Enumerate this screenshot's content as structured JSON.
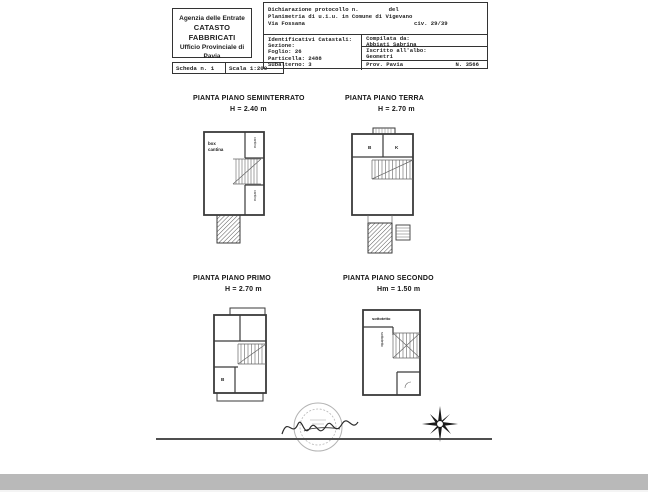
{
  "header": {
    "office": {
      "line1": "Agenzia delle Entrate",
      "line2": "CATASTO FABBRICATI",
      "line3": "Ufficio Provinciale di",
      "line4": "Pavia"
    },
    "sheet": {
      "scheda": "Scheda n. 1",
      "scala": "Scala 1:200"
    },
    "declaration": {
      "protocol": "Dichiarazione protocollo n.",
      "del": "del",
      "planimetria": "Planimetria di u.i.u. in Comune di Vigevano",
      "street": "Via Fossana",
      "civ": "civ. 29/39"
    },
    "catasto": {
      "title": "Identificativi Catastali:",
      "sezione": "Sezione:",
      "foglio": "Foglio: 26",
      "particella": "Particella: 2488",
      "subalterno": "Subalterno: 3"
    },
    "compiler": {
      "compilata_label": "Compilata da:",
      "compilata_name": "Abbiati Sabrina",
      "albo_label": "Iscritto all'albo:",
      "albo_value": "Geometri",
      "prov": "Prov. Pavia",
      "num": "N. 3566"
    }
  },
  "plans": {
    "seminterrato": {
      "title": "PIANTA PIANO SEMINTERRATO",
      "height": "H = 2.40 m",
      "label_box": "box",
      "label_cantina": "cantina",
      "label_right_top": "cantina",
      "label_right_bottom": "cantina"
    },
    "terra": {
      "title": "PIANTA PIANO TERRA",
      "height": "H = 2.70 m",
      "label_b": "B",
      "label_k": "K"
    },
    "primo": {
      "title": "PIANTA PIANO PRIMO",
      "height": "H = 2.70 m",
      "label_b": "B"
    },
    "secondo": {
      "title": "PIANTA PIANO SECONDO",
      "height": "Hm = 1.50 m",
      "label_top": "sottotetto",
      "label_left": "sottotetto"
    }
  },
  "colors": {
    "wall": "#3a3a3a",
    "scan_text": "#1f1f1f",
    "bottom_band": "#b9b9b9",
    "stamp": "#9a9a9a"
  }
}
